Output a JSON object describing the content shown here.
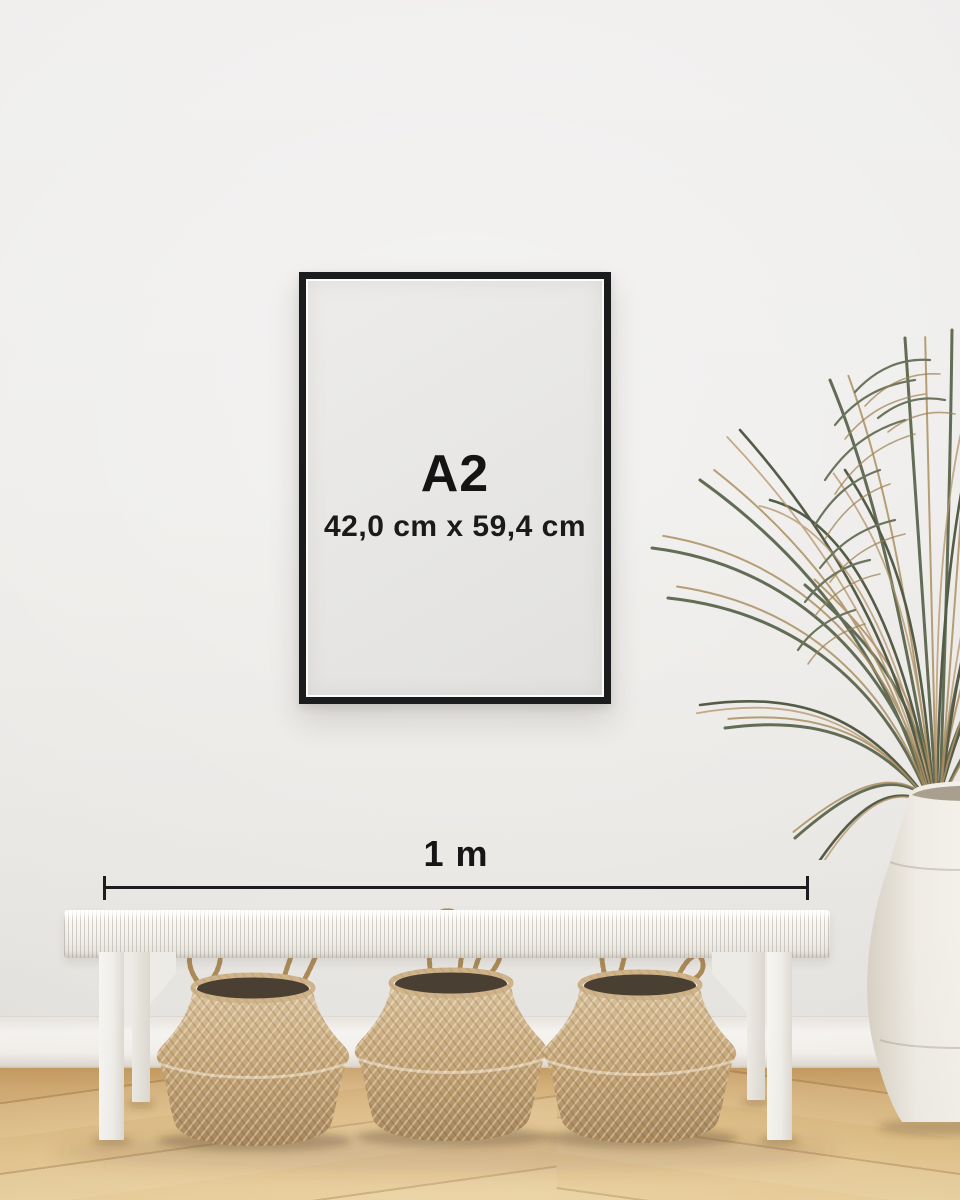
{
  "frame": {
    "size_label": "A2",
    "dimensions_label": "42,0 cm x 59,4 cm"
  },
  "measurement": {
    "label": "1 m"
  },
  "palette": {
    "wall": "#efeeec",
    "frame_border": "#1a1c1e",
    "frame_paper": "#e8e6e4",
    "label_text": "#141414",
    "ruler_line": "#1d1d1f",
    "baseboard": "#f3f1ee",
    "floor_wood": "#dbb980",
    "bench_white": "#f5f3ef",
    "basket_wicker": "#c3a478",
    "basket_interior": "#4a3f33",
    "plant_green": "#636c55",
    "plant_dried": "#a78a59",
    "vase_ceramic": "#efece5"
  }
}
